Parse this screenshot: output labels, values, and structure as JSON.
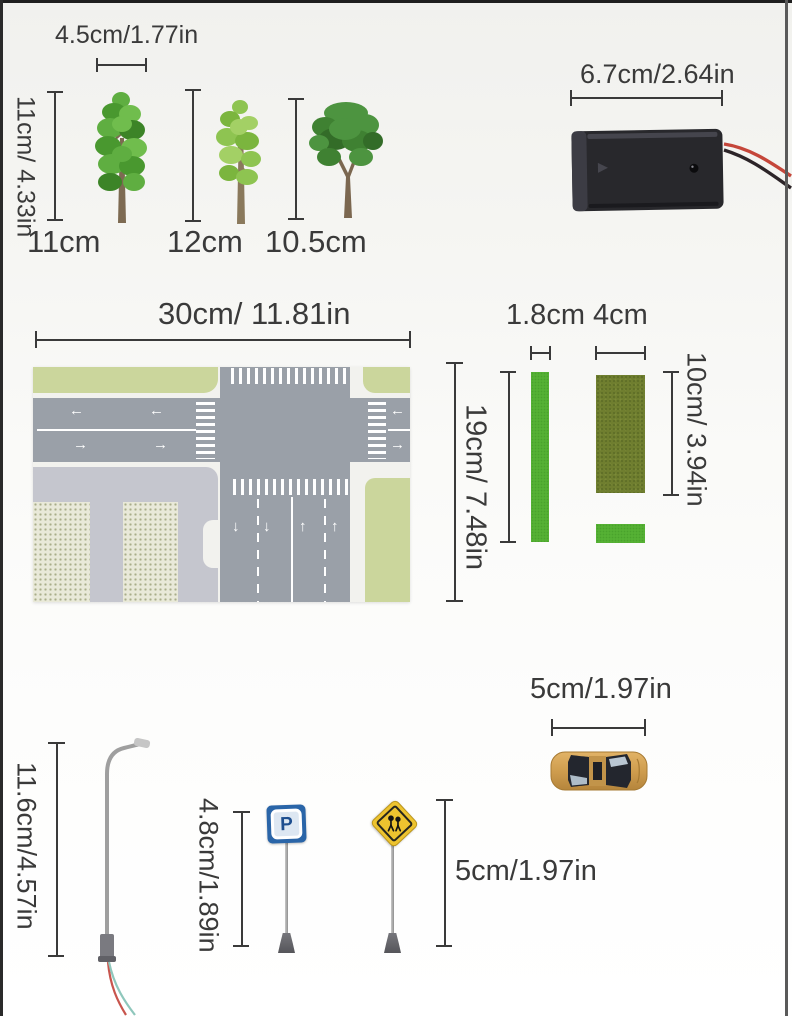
{
  "page": {
    "type": "product dimension diagram"
  },
  "items": {
    "trees": {
      "width_label": "4.5cm/1.77in",
      "height_label": "11cm/ 4.33in",
      "size_labels": [
        "11cm",
        "12cm",
        "10.5cm"
      ]
    },
    "battery_box": {
      "width_label": "6.7cm/2.64in"
    },
    "road_mat": {
      "width_label": "30cm/ 11.81in",
      "height_label": "19cm/ 7.48in",
      "arrow_left": "←",
      "arrow_right": "→",
      "arrow_up": "↑",
      "arrow_down": "↓"
    },
    "grass_strips": {
      "narrow_width_label": "1.8cm",
      "wide_width_label": "4cm",
      "height_label": "10cm/ 3.94in"
    },
    "street_lamp": {
      "height_label": "11.6cm/4.57in"
    },
    "parking_sign": {
      "height_label": "4.8cm/1.89in",
      "letter": "P"
    },
    "pedestrian_sign": {
      "height_label": "5cm/1.97in"
    },
    "car": {
      "width_label": "5cm/1.97in"
    }
  },
  "colors": {
    "text": "#3a3a3a",
    "measure_line": "#3a3a3a",
    "grass_bright": "#55b134",
    "grass_dark": "#6f7e2f",
    "mat_lawn": "#cbd69c",
    "road_gray": "#9aa0a8",
    "parking_gray": "#c5c6ce",
    "sign_blue": "#2a65a8",
    "sign_yellow": "#edc32f",
    "car_gold": "#cf9d4e",
    "battery_black": "#28282c"
  }
}
